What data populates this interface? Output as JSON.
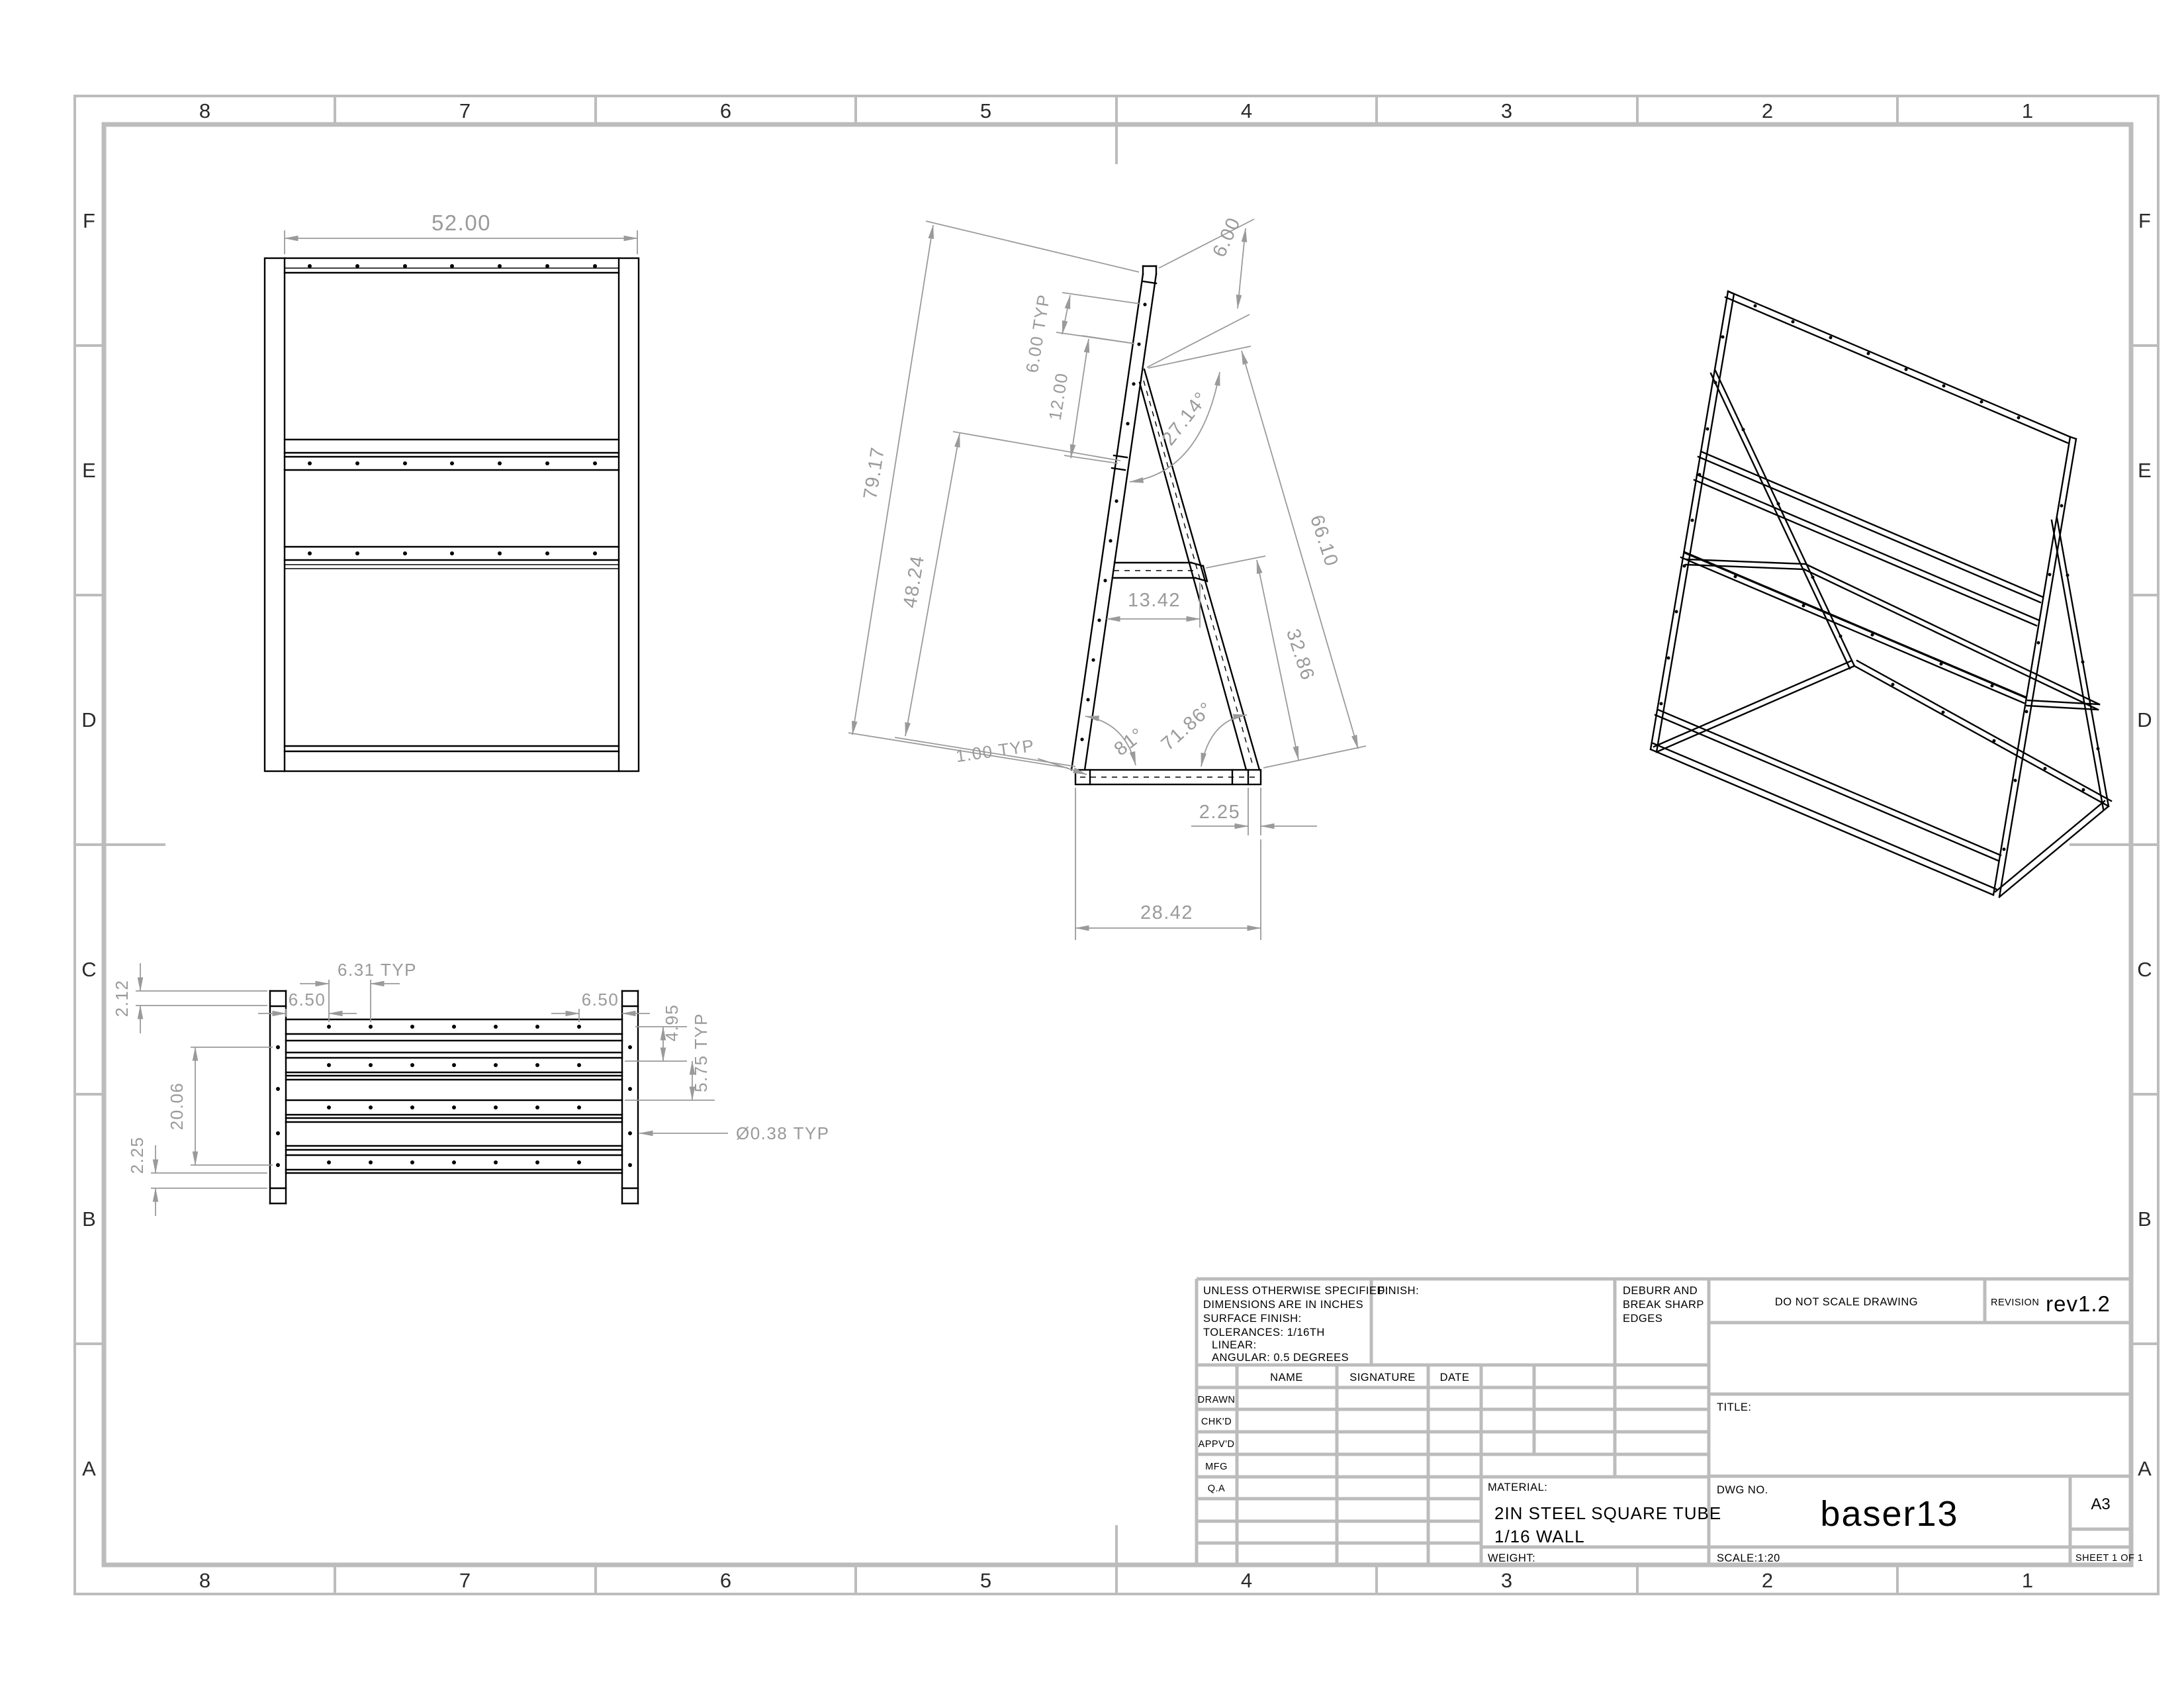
{
  "border": {
    "columns": [
      "8",
      "7",
      "6",
      "5",
      "4",
      "3",
      "2",
      "1"
    ],
    "rows": [
      "F",
      "E",
      "D",
      "C",
      "B",
      "A"
    ]
  },
  "title_block": {
    "spec_note": {
      "l1": "UNLESS OTHERWISE SPECIFIED:",
      "l2": "DIMENSIONS ARE IN INCHES",
      "l3": "SURFACE FINISH:",
      "l4": "TOLERANCES: 1/16TH",
      "l5": "LINEAR:",
      "l6": "ANGULAR: 0.5 DEGREES"
    },
    "finish_label": "FINISH:",
    "deburr_note": {
      "l1": "DEBURR AND",
      "l2": "BREAK SHARP",
      "l3": "EDGES"
    },
    "do_not_scale": "DO NOT SCALE DRAWING",
    "revision_label": "REVISION",
    "revision_value": "rev1.2",
    "columns": {
      "name": "NAME",
      "signature": "SIGNATURE",
      "date": "DATE"
    },
    "rows": {
      "drawn": "DRAWN",
      "chkd": "CHK'D",
      "appvd": "APPV'D",
      "mfg": "MFG",
      "qa": "Q.A"
    },
    "title_label": "TITLE:",
    "dwg_label": "DWG NO.",
    "dwg_value": "baser13",
    "size": "A3",
    "material_label": "MATERIAL:",
    "material_line1": "2IN STEEL SQUARE TUBE",
    "material_line2": "1/16 WALL",
    "weight_label": "WEIGHT:",
    "scale": "SCALE:1:20",
    "sheet": "SHEET 1 OF 1"
  },
  "views": {
    "front": {
      "width": "52.00"
    },
    "side": {
      "overall_length": "79.17",
      "lower_length": "48.24",
      "top_overhang": "6.00",
      "rung_pitch": "6.00 TYP",
      "rung_pitch_2": "12.00",
      "apex_angle": "27.14°",
      "brace_length": "66.10",
      "brace_lower": "32.86",
      "shelf_depth": "13.42",
      "front_angle": "81°",
      "brace_angle": "71.86°",
      "tube_note": "1.00 TYP",
      "foot_width": "2.25",
      "base_depth": "28.42"
    },
    "plan": {
      "hole_pitch": "6.31 TYP",
      "edge_offset_left": "6.50",
      "edge_offset_right": "6.50",
      "end_tab": "2.12",
      "rail_span": "20.06",
      "foot_depth": "2.25",
      "row_gap_1": "4.95",
      "row_gap_2": "5.75 TYP",
      "hole_dia": "Ø0.38 TYP"
    }
  },
  "colors": {
    "geometry": "#000000",
    "dimension": "#9a9a9a",
    "border": "#bcbcbc",
    "background": "#ffffff"
  }
}
